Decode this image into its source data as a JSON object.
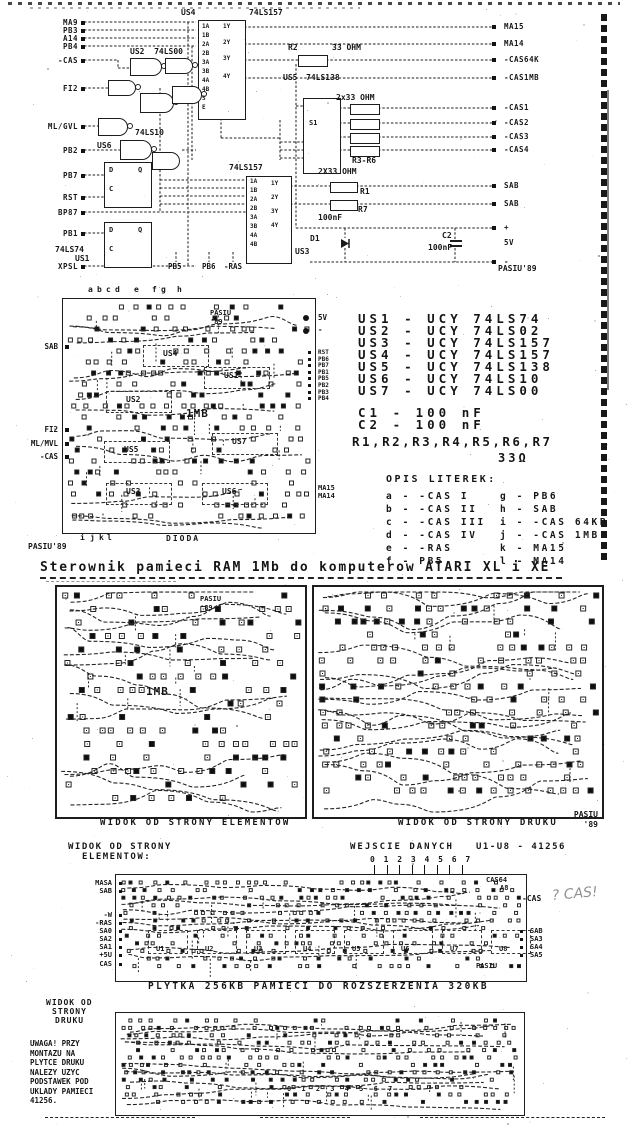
{
  "page": {
    "title": "Sterownik pamieci RAM 1Mb do komputerow ATARI XL i XE"
  },
  "schematic": {
    "left_labels": [
      "MA9",
      "PB3",
      "A14",
      "PB4",
      "-CAS",
      "FI2",
      "ML/GVL",
      "PB2",
      "PB7",
      "RST",
      "BP87",
      "PB1",
      "XPSL"
    ],
    "right_labels": [
      "MA15",
      "MA14",
      "-CAS64K",
      "-CAS1MB",
      "-CAS1",
      "-CAS2",
      "-CAS3",
      "-CAS4",
      "SAB",
      "SAB",
      "+",
      "5V",
      "-"
    ],
    "bottom_pins": [
      "PB5",
      "PB6",
      "-RAS"
    ],
    "us4": {
      "name": "US4",
      "part": "74LS157",
      "left_pins": [
        "1A",
        "1B",
        "2A",
        "2B",
        "3A",
        "3B",
        "4A",
        "4B",
        "S",
        "E"
      ],
      "right_pins": [
        "1Y",
        "2Y",
        "3Y",
        "4Y"
      ]
    },
    "us3": {
      "name": "US3",
      "part": "74LS157",
      "left_pins": [
        "1A",
        "1B",
        "2A",
        "2B",
        "3A",
        "3B",
        "4A",
        "4B"
      ],
      "right_pins": [
        "1Y",
        "2Y",
        "3Y",
        "4Y"
      ]
    },
    "us5": {
      "name": "US5",
      "part": "74LS138",
      "tag": "S1"
    },
    "us2_label": "US2  74LS00",
    "us6_label": "74LS10",
    "us6_name": "US6",
    "us1_part": "74LS74",
    "us1_name": "US1",
    "ff_pins": {
      "d": "D",
      "q": "Q",
      "c": "C"
    },
    "r2": "R2",
    "r2_val": "33 OHM",
    "r36": "R3-R6",
    "r36_val": "2x33 OHM",
    "r17_val": "2X33 OHM",
    "r1": "R1",
    "r7": "R7",
    "c1_val": "100nF",
    "d1": "D1",
    "c2": "C2",
    "c2_val": "100nF",
    "signature": "PASIU'89"
  },
  "board1": {
    "top_letters": [
      "a",
      "b",
      "c",
      "d",
      "e",
      "f",
      "g",
      "h"
    ],
    "bottom_letters": [
      "i",
      "j",
      "k",
      "l"
    ],
    "left_labels": [
      "SAB",
      "FI2",
      "ML/MVL",
      "-CAS"
    ],
    "right_top": [
      "5V",
      "-"
    ],
    "right_mid": [
      "RST",
      "PB6",
      "PB7",
      "PB1",
      "PB5",
      "PB2",
      "PB3",
      "PB4"
    ],
    "right_bot": [
      "MA15",
      "MA14"
    ],
    "ics": [
      "US4",
      "US2",
      "US1",
      "US7",
      "US5",
      "US3",
      "US6"
    ],
    "size_label": "1MB",
    "inner_sig": "PASIU '89",
    "dioda": "DIODA",
    "signature": "PASIU'89"
  },
  "parts": {
    "ics": [
      "US1 - UCY 74LS74",
      "US2 - UCY 74LS02",
      "US3 - UCY 74LS157",
      "US4 - UCY 74LS157",
      "US5 - UCY 74LS138",
      "US6 - UCY 74LS10",
      "US7 - UCY 74LS00"
    ],
    "caps": [
      "C1 - 100 nF",
      "C2 - 100 nF"
    ],
    "res_line": "R1,R2,R3,R4,R5,R6,R7",
    "res_val": "33Ω",
    "legend_title": "OPIS LITEREK:",
    "legend_left": [
      "a - -CAS I",
      "b - -CAS II",
      "c - -CAS III",
      "d - -CAS IV",
      "e - -RAS",
      "f - PB5"
    ],
    "legend_right": [
      "g - PB6",
      "h - SAB",
      "i - -CAS 64KB",
      "j - -CAS 1MB",
      "k - MA15",
      "l - MA14"
    ]
  },
  "views": {
    "left_caption": "WIDOK OD STRONY ELEMENTOW",
    "right_caption": "WIDOK OD STRONY DRUKU",
    "signature": "PASIU '89",
    "left_sig": "PASIU '89",
    "left_size": "1MB"
  },
  "memory": {
    "hdr_left1": "WIDOK OD STRONY",
    "hdr_left2": "ELEMENTOW:",
    "hdr_center": "WEJSCIE DANYCH",
    "hdr_digits": "0 1 2 3 4 5 6 7",
    "hdr_right": "U1-U8 - 41256",
    "left_labels": [
      "MASA",
      "SAB",
      "-W",
      "-RAS",
      "SA0",
      "SA2",
      "SA1",
      "+5U",
      "CAS"
    ],
    "right_labels": [
      "SAB",
      "SA3",
      "SA4",
      "SA5"
    ],
    "cas_label": "-CAS",
    "handwriting": "? CAS!",
    "top_right1": "CAS64",
    "top_right2": "A8",
    "chips": [
      "U1",
      "U2",
      "U3",
      "U4",
      "U5",
      "U6",
      "U7",
      "U8"
    ],
    "inner_sig": "PASIU",
    "caption": "PLYTKA 256KB PAMIECI DO ROZSZERZENIA 320KB"
  },
  "bottom": {
    "view1": "WIDOK OD",
    "view2": "STRONY",
    "view3": "DRUKU",
    "notes": [
      "UWAGA! PRZY",
      "MONTAZU NA",
      "PLYTCE DRUKU",
      "NALEZY UZYC",
      "PODSTAWEK POD",
      "UKLADY PAMIECI",
      "41256."
    ],
    "digits": "0 1 2 3 4 5 6 7"
  }
}
